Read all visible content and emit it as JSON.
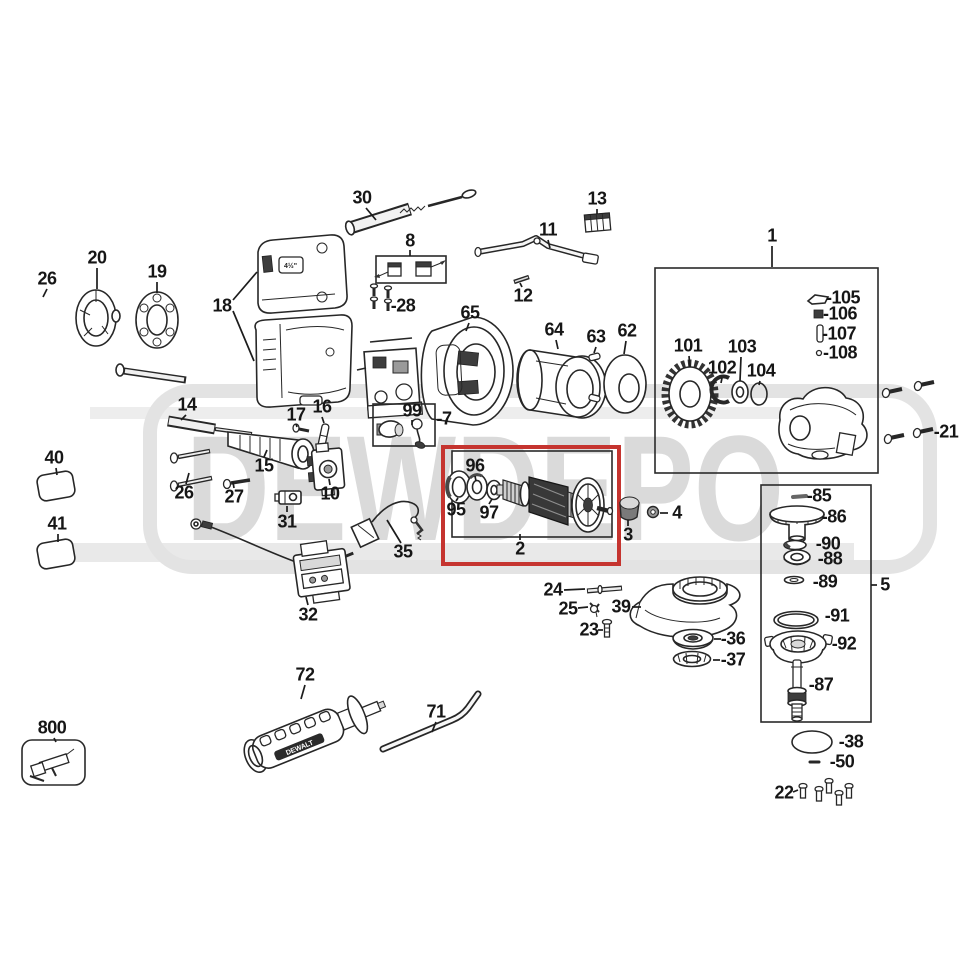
{
  "watermark": {
    "text": "DEWDEPO"
  },
  "badges": {
    "housing_size_label": "4½\"",
    "handle_brand": "DEWALT"
  },
  "highlight": {
    "color": "#c5342f",
    "highlighted_part": "2"
  },
  "diagram": {
    "type": "exploded-parts-diagram",
    "labels": [
      {
        "id": "26a",
        "text": "26",
        "x": 47,
        "y": 279,
        "leaders": [
          [
            47,
            289,
            43,
            297
          ]
        ]
      },
      {
        "id": "20",
        "text": "20",
        "x": 97,
        "y": 258,
        "leaders": [
          [
            97,
            268,
            97,
            289
          ]
        ]
      },
      {
        "id": "19",
        "text": "19",
        "x": 157,
        "y": 272,
        "leaders": [
          [
            157,
            282,
            157,
            293
          ]
        ]
      },
      {
        "id": "18",
        "text": "18",
        "x": 222,
        "y": 306,
        "leaders": [
          [
            233,
            300,
            257,
            272
          ],
          [
            233,
            311,
            254,
            361
          ]
        ]
      },
      {
        "id": "30",
        "text": "30",
        "x": 362,
        "y": 198,
        "leaders": [
          [
            366,
            208,
            376,
            220
          ]
        ]
      },
      {
        "id": "8",
        "text": "8",
        "x": 410,
        "y": 241,
        "leaders": [
          [
            410,
            250,
            410,
            256
          ]
        ]
      },
      {
        "id": "28",
        "text": "-28",
        "x": 403,
        "y": 306
      },
      {
        "id": "11",
        "text": "11",
        "x": 548,
        "y": 230,
        "leaders": [
          [
            548,
            240,
            550,
            248
          ]
        ]
      },
      {
        "id": "12",
        "text": "12",
        "x": 523,
        "y": 296,
        "leaders": [
          [
            522,
            287,
            520,
            283
          ]
        ]
      },
      {
        "id": "13",
        "text": "13",
        "x": 597,
        "y": 199,
        "leaders": [
          [
            597,
            209,
            597,
            214
          ]
        ]
      },
      {
        "id": "65",
        "text": "65",
        "x": 470,
        "y": 313,
        "leaders": [
          [
            469,
            323,
            466,
            331
          ]
        ]
      },
      {
        "id": "64",
        "text": "64",
        "x": 554,
        "y": 330,
        "leaders": [
          [
            556,
            340,
            558,
            349
          ]
        ]
      },
      {
        "id": "63",
        "text": "63",
        "x": 596,
        "y": 337,
        "leaders": [
          [
            596,
            347,
            594,
            353
          ]
        ]
      },
      {
        "id": "62",
        "text": "62",
        "x": 627,
        "y": 331,
        "leaders": [
          [
            626,
            341,
            624,
            354
          ]
        ]
      },
      {
        "id": "1",
        "text": "1",
        "x": 772,
        "y": 236,
        "leaders": [
          [
            772,
            246,
            772,
            267
          ]
        ]
      },
      {
        "id": "101",
        "text": "101",
        "x": 688,
        "y": 346,
        "leaders": [
          [
            689,
            356,
            690,
            367
          ]
        ]
      },
      {
        "id": "102",
        "text": "102",
        "x": 722,
        "y": 368,
        "leaders": [
          [
            722,
            378,
            721,
            383
          ]
        ]
      },
      {
        "id": "103",
        "text": "103",
        "x": 742,
        "y": 347,
        "leaders": [
          [
            741,
            357,
            740,
            381
          ]
        ]
      },
      {
        "id": "104",
        "text": "104",
        "x": 761,
        "y": 371,
        "leaders": [
          [
            760,
            381,
            759,
            385
          ]
        ]
      },
      {
        "id": "105",
        "text": "-105",
        "x": 843,
        "y": 298
      },
      {
        "id": "106",
        "text": "-106",
        "x": 840,
        "y": 314
      },
      {
        "id": "107",
        "text": "-107",
        "x": 839,
        "y": 334
      },
      {
        "id": "108",
        "text": "-108",
        "x": 840,
        "y": 353
      },
      {
        "id": "21",
        "text": "-21",
        "x": 946,
        "y": 432
      },
      {
        "id": "14",
        "text": "14",
        "x": 187,
        "y": 405,
        "leaders": [
          [
            186,
            415,
            181,
            420
          ]
        ]
      },
      {
        "id": "17",
        "text": "17",
        "x": 296,
        "y": 415,
        "leaders": [
          [
            296,
            424,
            297,
            427
          ]
        ]
      },
      {
        "id": "16",
        "text": "16",
        "x": 322,
        "y": 407,
        "leaders": [
          [
            322,
            417,
            324,
            423
          ]
        ]
      },
      {
        "id": "99",
        "text": "99",
        "x": 412,
        "y": 411,
        "leaders": [
          [
            412,
            420,
            412,
            425
          ]
        ]
      },
      {
        "id": "7",
        "text": "-7",
        "x": 444,
        "y": 419
      },
      {
        "id": "15",
        "text": "15",
        "x": 264,
        "y": 466,
        "leaders": [
          [
            264,
            457,
            267,
            450
          ]
        ]
      },
      {
        "id": "26b",
        "text": "26",
        "x": 184,
        "y": 493,
        "leaders": [
          [
            186,
            484,
            189,
            473
          ]
        ]
      },
      {
        "id": "27",
        "text": "27",
        "x": 234,
        "y": 497,
        "leaders": [
          [
            234,
            488,
            233,
            482
          ]
        ]
      },
      {
        "id": "31",
        "text": "31",
        "x": 287,
        "y": 522,
        "leaders": [
          [
            287,
            512,
            287,
            506
          ]
        ]
      },
      {
        "id": "10",
        "text": "10",
        "x": 330,
        "y": 494,
        "leaders": [
          [
            330,
            485,
            329,
            479
          ]
        ]
      },
      {
        "id": "35",
        "text": "35",
        "x": 403,
        "y": 552,
        "leaders": [
          [
            401,
            543,
            387,
            520
          ]
        ]
      },
      {
        "id": "32",
        "text": "32",
        "x": 308,
        "y": 615,
        "leaders": [
          [
            308,
            605,
            306,
            597
          ]
        ]
      },
      {
        "id": "40",
        "text": "40",
        "x": 54,
        "y": 458,
        "leaders": [
          [
            56,
            468,
            57,
            475
          ]
        ]
      },
      {
        "id": "41",
        "text": "41",
        "x": 57,
        "y": 524,
        "leaders": [
          [
            58,
            534,
            58,
            542
          ]
        ]
      },
      {
        "id": "96",
        "text": "96",
        "x": 475,
        "y": 466,
        "leaders": [
          [
            475,
            476,
            476,
            481
          ]
        ]
      },
      {
        "id": "95",
        "text": "95",
        "x": 456,
        "y": 510,
        "leaders": [
          [
            456,
            501,
            458,
            498
          ]
        ]
      },
      {
        "id": "97",
        "text": "97",
        "x": 489,
        "y": 513,
        "leaders": [
          [
            489,
            504,
            492,
            499
          ]
        ]
      },
      {
        "id": "2",
        "text": "2",
        "x": 520,
        "y": 549,
        "leaders": [
          [
            520,
            540,
            520,
            534
          ]
        ]
      },
      {
        "id": "3",
        "text": "3",
        "x": 628,
        "y": 535,
        "leaders": [
          [
            628,
            526,
            628,
            520
          ]
        ]
      },
      {
        "id": "4",
        "text": "4",
        "x": 677,
        "y": 513,
        "leaders": [
          [
            660,
            513,
            668,
            513
          ]
        ]
      },
      {
        "id": "85",
        "text": "-85",
        "x": 819,
        "y": 496
      },
      {
        "id": "86",
        "text": "-86",
        "x": 834,
        "y": 517
      },
      {
        "id": "90",
        "text": "-90",
        "x": 828,
        "y": 544
      },
      {
        "id": "88",
        "text": "-88",
        "x": 830,
        "y": 559
      },
      {
        "id": "89",
        "text": "-89",
        "x": 825,
        "y": 582
      },
      {
        "id": "5",
        "text": "5",
        "x": 885,
        "y": 585,
        "leaders": [
          [
            871,
            585,
            877,
            585
          ]
        ]
      },
      {
        "id": "91",
        "text": "-91",
        "x": 837,
        "y": 616
      },
      {
        "id": "92",
        "text": "-92",
        "x": 844,
        "y": 644
      },
      {
        "id": "87",
        "text": "-87",
        "x": 821,
        "y": 685
      },
      {
        "id": "24",
        "text": "24",
        "x": 553,
        "y": 590,
        "leaders": [
          [
            564,
            590,
            585,
            589
          ]
        ]
      },
      {
        "id": "25",
        "text": "25",
        "x": 568,
        "y": 609,
        "leaders": [
          [
            578,
            608,
            588,
            607
          ]
        ]
      },
      {
        "id": "39",
        "text": "39",
        "x": 621,
        "y": 607,
        "leaders": [
          [
            632,
            607,
            641,
            607
          ]
        ]
      },
      {
        "id": "23",
        "text": "23",
        "x": 589,
        "y": 630,
        "leaders": [
          [
            598,
            630,
            603,
            630
          ]
        ]
      },
      {
        "id": "36",
        "text": "-36",
        "x": 733,
        "y": 639,
        "leaders": [
          [
            714,
            639,
            721,
            639
          ]
        ]
      },
      {
        "id": "37",
        "text": "-37",
        "x": 733,
        "y": 660,
        "leaders": [
          [
            713,
            660,
            720,
            660
          ]
        ]
      },
      {
        "id": "38",
        "text": "-38",
        "x": 851,
        "y": 742
      },
      {
        "id": "50",
        "text": "-50",
        "x": 842,
        "y": 762
      },
      {
        "id": "22",
        "text": "22",
        "x": 784,
        "y": 793,
        "leaders": [
          [
            793,
            792,
            798,
            790
          ]
        ]
      },
      {
        "id": "72",
        "text": "72",
        "x": 305,
        "y": 675,
        "leaders": [
          [
            305,
            685,
            301,
            699
          ]
        ]
      },
      {
        "id": "71",
        "text": "71",
        "x": 436,
        "y": 712,
        "leaders": [
          [
            436,
            722,
            432,
            732
          ]
        ]
      },
      {
        "id": "800",
        "text": "800",
        "x": 52,
        "y": 728,
        "leaders": [
          [
            54,
            738,
            56,
            742
          ]
        ]
      }
    ]
  }
}
